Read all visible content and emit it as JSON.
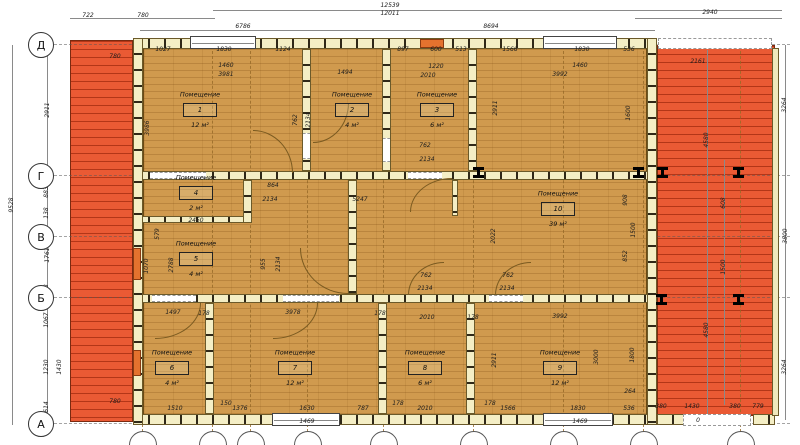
{
  "drawing": {
    "room_label": "Помещение",
    "rooms": [
      {
        "num": "1",
        "area": "12 м²",
        "x": 200,
        "y": 110
      },
      {
        "num": "2",
        "area": "4 м²",
        "x": 352,
        "y": 110
      },
      {
        "num": "3",
        "area": "6 м²",
        "x": 437,
        "y": 110
      },
      {
        "num": "4",
        "area": "2 м²",
        "x": 196,
        "y": 193
      },
      {
        "num": "5",
        "area": "4 м²",
        "x": 196,
        "y": 259
      },
      {
        "num": "6",
        "area": "4 м²",
        "x": 172,
        "y": 368
      },
      {
        "num": "7",
        "area": "12 м²",
        "x": 295,
        "y": 368
      },
      {
        "num": "8",
        "area": "6 м²",
        "x": 425,
        "y": 368
      },
      {
        "num": "9",
        "area": "12 м²",
        "x": 560,
        "y": 368
      },
      {
        "num": "10",
        "area": "39 м²",
        "x": 558,
        "y": 209
      }
    ],
    "row_axes": [
      {
        "label": "Д",
        "y": 44
      },
      {
        "label": "Г",
        "y": 175
      },
      {
        "label": "В",
        "y": 236
      },
      {
        "label": "Б",
        "y": 297
      },
      {
        "label": "А",
        "y": 423
      }
    ],
    "col_axis_x": [
      142,
      212,
      250,
      307,
      383,
      473,
      563,
      643,
      740
    ],
    "terraces": [
      {
        "side": "left",
        "x": 70,
        "y": 40,
        "w": 63,
        "h": 382
      },
      {
        "side": "right",
        "x": 657,
        "y": 45,
        "w": 118,
        "h": 371
      }
    ],
    "floor": [
      143,
      48,
      504,
      367
    ],
    "walls_h": [
      [
        133,
        38,
        524,
        11
      ],
      [
        133,
        171,
        524,
        9
      ],
      [
        133,
        216,
        118,
        7
      ],
      [
        133,
        294,
        524,
        9
      ],
      [
        133,
        414,
        524,
        11
      ],
      [
        742,
        39,
        24,
        10
      ],
      [
        657,
        414,
        28,
        11
      ],
      [
        753,
        414,
        22,
        11
      ]
    ],
    "walls_v": [
      [
        133,
        38,
        10,
        387
      ],
      [
        647,
        38,
        10,
        387
      ],
      [
        302,
        49,
        9,
        122
      ],
      [
        382,
        49,
        9,
        122
      ],
      [
        468,
        49,
        9,
        122
      ],
      [
        243,
        180,
        9,
        43
      ],
      [
        348,
        180,
        9,
        114
      ],
      [
        452,
        180,
        6,
        36
      ],
      [
        205,
        303,
        9,
        111
      ],
      [
        378,
        303,
        9,
        111
      ],
      [
        466,
        303,
        9,
        111
      ]
    ],
    "strips": [
      [
        772,
        48,
        7,
        368
      ]
    ],
    "gaps": [
      [
        150,
        172,
        56,
        7
      ],
      [
        408,
        172,
        34,
        7
      ],
      [
        152,
        295,
        44,
        7
      ],
      [
        283,
        295,
        56,
        7
      ],
      [
        489,
        295,
        34,
        7
      ],
      [
        303,
        133,
        7,
        26
      ],
      [
        383,
        138,
        7,
        24
      ]
    ],
    "windows": [
      [
        190,
        36,
        66,
        13
      ],
      [
        543,
        36,
        74,
        13
      ],
      [
        272,
        413,
        68,
        13
      ],
      [
        543,
        413,
        70,
        13
      ]
    ],
    "orange_marks": [
      [
        420,
        39,
        24,
        9
      ],
      [
        133,
        248,
        8,
        32
      ],
      [
        133,
        350,
        8,
        26
      ]
    ],
    "dashed_boxes": [
      [
        658,
        38,
        114,
        11
      ],
      [
        683,
        414,
        68,
        12
      ]
    ],
    "arcs": [
      {
        "x": 253,
        "y": 130,
        "w": 40,
        "h": 43,
        "c": "tr"
      },
      {
        "x": 313,
        "y": 103,
        "w": 36,
        "h": 40,
        "c": "br"
      },
      {
        "x": 410,
        "y": 178,
        "w": 42,
        "h": 34,
        "c": "tl"
      },
      {
        "x": 300,
        "y": 248,
        "w": 48,
        "h": 46,
        "c": "bl"
      },
      {
        "x": 155,
        "y": 303,
        "w": 46,
        "h": 36,
        "c": "br"
      },
      {
        "x": 273,
        "y": 303,
        "w": 45,
        "h": 36,
        "c": "br"
      },
      {
        "x": 408,
        "y": 262,
        "w": 36,
        "h": 33,
        "c": "tl"
      },
      {
        "x": 495,
        "y": 262,
        "w": 36,
        "h": 33,
        "c": "tl"
      }
    ],
    "ibeams": [
      [
        478,
        172
      ],
      [
        638,
        172
      ],
      [
        662,
        172
      ],
      [
        738,
        172
      ],
      [
        661,
        299
      ],
      [
        738,
        299
      ]
    ],
    "dim_lines_h": [
      [
        70,
        18,
        145
      ],
      [
        213,
        10,
        569
      ],
      [
        140,
        30,
        515
      ],
      [
        635,
        18,
        147
      ]
    ],
    "dim_lines_v": [
      [
        12,
        45,
        380
      ],
      [
        47,
        45,
        380
      ],
      [
        785,
        45,
        375
      ],
      [
        707,
        50,
        365
      ],
      [
        724,
        160,
        245
      ]
    ],
    "dims": [
      {
        "t": "722",
        "x": 88,
        "y": 16
      },
      {
        "t": "780",
        "x": 143,
        "y": 16
      },
      {
        "t": "12539",
        "x": 390,
        "y": 6
      },
      {
        "t": "12011",
        "x": 390,
        "y": 14
      },
      {
        "t": "2940",
        "x": 710,
        "y": 13
      },
      {
        "t": "6786",
        "x": 243,
        "y": 27
      },
      {
        "t": "8694",
        "x": 491,
        "y": 27
      },
      {
        "t": "780",
        "x": 115,
        "y": 57
      },
      {
        "t": "1027",
        "x": 163,
        "y": 50
      },
      {
        "t": "1830",
        "x": 224,
        "y": 50
      },
      {
        "t": "1124",
        "x": 283,
        "y": 50
      },
      {
        "t": "897",
        "x": 403,
        "y": 50
      },
      {
        "t": "600",
        "x": 436,
        "y": 50
      },
      {
        "t": "513",
        "x": 461,
        "y": 50
      },
      {
        "t": "1566",
        "x": 510,
        "y": 50
      },
      {
        "t": "1830",
        "x": 582,
        "y": 50
      },
      {
        "t": "536",
        "x": 629,
        "y": 50
      },
      {
        "t": "1460",
        "x": 226,
        "y": 66
      },
      {
        "t": "3981",
        "x": 226,
        "y": 75
      },
      {
        "t": "1494",
        "x": 345,
        "y": 73
      },
      {
        "t": "1220",
        "x": 436,
        "y": 67
      },
      {
        "t": "2010",
        "x": 428,
        "y": 76
      },
      {
        "t": "1460",
        "x": 580,
        "y": 66
      },
      {
        "t": "3992",
        "x": 560,
        "y": 75
      },
      {
        "t": "2161",
        "x": 698,
        "y": 62
      },
      {
        "t": "864",
        "x": 273,
        "y": 186
      },
      {
        "t": "2134",
        "x": 270,
        "y": 200
      },
      {
        "t": "5247",
        "x": 360,
        "y": 200
      },
      {
        "t": "762",
        "x": 425,
        "y": 146
      },
      {
        "t": "2134",
        "x": 427,
        "y": 160
      },
      {
        "t": "2450",
        "x": 196,
        "y": 221
      },
      {
        "t": "1497",
        "x": 173,
        "y": 313
      },
      {
        "t": "178",
        "x": 204,
        "y": 314
      },
      {
        "t": "3978",
        "x": 293,
        "y": 313
      },
      {
        "t": "178",
        "x": 380,
        "y": 314
      },
      {
        "t": "762",
        "x": 426,
        "y": 276
      },
      {
        "t": "2134",
        "x": 425,
        "y": 289
      },
      {
        "t": "762",
        "x": 508,
        "y": 276
      },
      {
        "t": "2134",
        "x": 507,
        "y": 289
      },
      {
        "t": "2010",
        "x": 427,
        "y": 318
      },
      {
        "t": "178",
        "x": 473,
        "y": 318
      },
      {
        "t": "3992",
        "x": 560,
        "y": 317
      },
      {
        "t": "264",
        "x": 630,
        "y": 392
      },
      {
        "t": "780",
        "x": 115,
        "y": 402
      },
      {
        "t": "1510",
        "x": 175,
        "y": 409
      },
      {
        "t": "150",
        "x": 226,
        "y": 404
      },
      {
        "t": "1376",
        "x": 240,
        "y": 409
      },
      {
        "t": "1630",
        "x": 307,
        "y": 409
      },
      {
        "t": "1469",
        "x": 307,
        "y": 422
      },
      {
        "t": "787",
        "x": 363,
        "y": 409
      },
      {
        "t": "178",
        "x": 398,
        "y": 404
      },
      {
        "t": "2010",
        "x": 425,
        "y": 409
      },
      {
        "t": "178",
        "x": 490,
        "y": 404
      },
      {
        "t": "1566",
        "x": 508,
        "y": 409
      },
      {
        "t": "1830",
        "x": 578,
        "y": 409
      },
      {
        "t": "536",
        "x": 629,
        "y": 409
      },
      {
        "t": "1469",
        "x": 580,
        "y": 422
      },
      {
        "t": "380",
        "x": 661,
        "y": 407
      },
      {
        "t": "1430",
        "x": 692,
        "y": 407
      },
      {
        "t": "380",
        "x": 735,
        "y": 407
      },
      {
        "t": "779",
        "x": 758,
        "y": 407
      },
      {
        "t": "0",
        "x": 698,
        "y": 421
      },
      {
        "t": "9528",
        "x": 12,
        "y": 205,
        "r": 1
      },
      {
        "t": "2911",
        "x": 48,
        "y": 110,
        "r": 1
      },
      {
        "t": "883",
        "x": 47,
        "y": 192,
        "r": 1
      },
      {
        "t": "138",
        "x": 47,
        "y": 213,
        "r": 1
      },
      {
        "t": "1761",
        "x": 48,
        "y": 255,
        "r": 1
      },
      {
        "t": "138",
        "x": 47,
        "y": 290,
        "r": 1
      },
      {
        "t": "1067",
        "x": 47,
        "y": 320,
        "r": 1
      },
      {
        "t": "1230",
        "x": 47,
        "y": 367,
        "r": 1
      },
      {
        "t": "1430",
        "x": 60,
        "y": 367,
        "r": 1
      },
      {
        "t": "614",
        "x": 47,
        "y": 407,
        "r": 1
      },
      {
        "t": "3986",
        "x": 148,
        "y": 128,
        "r": 1
      },
      {
        "t": "762",
        "x": 296,
        "y": 120,
        "r": 1
      },
      {
        "t": "2134",
        "x": 309,
        "y": 120,
        "r": 1
      },
      {
        "t": "2911",
        "x": 496,
        "y": 108,
        "r": 1
      },
      {
        "t": "1600",
        "x": 629,
        "y": 113,
        "r": 1
      },
      {
        "t": "2022",
        "x": 494,
        "y": 236,
        "r": 1
      },
      {
        "t": "908",
        "x": 626,
        "y": 200,
        "r": 1
      },
      {
        "t": "1500",
        "x": 634,
        "y": 230,
        "r": 1
      },
      {
        "t": "852",
        "x": 626,
        "y": 256,
        "r": 1
      },
      {
        "t": "579",
        "x": 158,
        "y": 234,
        "r": 1
      },
      {
        "t": "1070",
        "x": 147,
        "y": 266,
        "r": 1
      },
      {
        "t": "2788",
        "x": 172,
        "y": 265,
        "r": 1
      },
      {
        "t": "955",
        "x": 264,
        "y": 264,
        "r": 1
      },
      {
        "t": "2134",
        "x": 279,
        "y": 264,
        "r": 1
      },
      {
        "t": "2911",
        "x": 495,
        "y": 360,
        "r": 1
      },
      {
        "t": "3000",
        "x": 597,
        "y": 357,
        "r": 1
      },
      {
        "t": "1800",
        "x": 633,
        "y": 355,
        "r": 1
      },
      {
        "t": "3264",
        "x": 785,
        "y": 105,
        "r": 1
      },
      {
        "t": "4580",
        "x": 707,
        "y": 140,
        "r": 1
      },
      {
        "t": "608",
        "x": 724,
        "y": 203,
        "r": 1
      },
      {
        "t": "3800",
        "x": 786,
        "y": 236,
        "r": 1
      },
      {
        "t": "1500",
        "x": 724,
        "y": 267,
        "r": 1
      },
      {
        "t": "4580",
        "x": 707,
        "y": 330,
        "r": 1
      },
      {
        "t": "3264",
        "x": 785,
        "y": 367,
        "r": 1
      }
    ],
    "colors": {
      "terrace": "#ea5a34",
      "floor": "#d09a4e",
      "wall": "#f4eec5",
      "accent_orange": "#e4722e"
    }
  }
}
